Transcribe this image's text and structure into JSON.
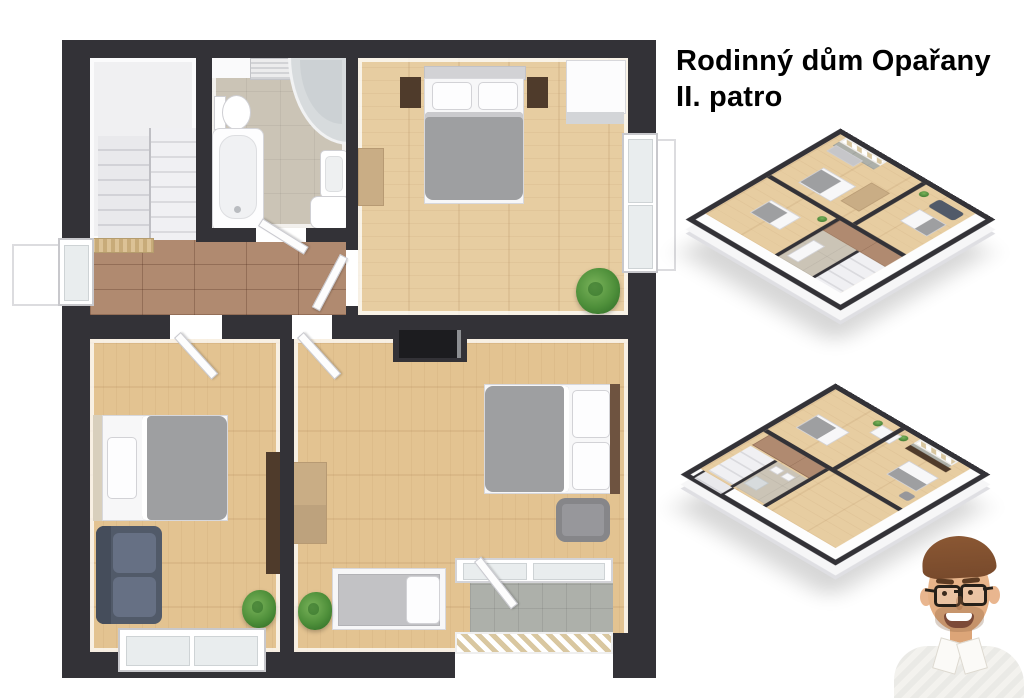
{
  "title": {
    "line1": "Rodinný dům Opařany",
    "line2": "II. patro"
  },
  "legend": [
    "staircase",
    "hallway",
    "bathroom",
    "bathtub",
    "shower",
    "toilet",
    "sink",
    "towel-radiator",
    "double-bed",
    "single-bed",
    "sofa",
    "armchair",
    "wardrobe",
    "nightstand",
    "dresser",
    "desk",
    "plant",
    "window",
    "door",
    "balcony",
    "railing",
    "tv-niche",
    "doormat",
    "agent-photo"
  ],
  "colors": {
    "wall": "#333237",
    "woodFloor": "#e7cda1",
    "woodFloorDeep": "#e3c391",
    "tileFloor": "#b08a70",
    "bathFloor": "#cbc4b6",
    "stairsFloor": "#f0f0f2",
    "balconyFloor": "#adb0aa",
    "railingTan": "#d9c7a0",
    "blanketGray": "#9e9fa1",
    "mattressWhite": "#f7f7f8",
    "sofaNavy": "#515a69",
    "plantGreen": "#4e8f3a",
    "darkWoodBrown": "#4f3b2b",
    "tanWood": "#c9ad85",
    "nicheBlack": "#1c1c1f",
    "skin": "#e9b68f",
    "skinShadow": "#dca578",
    "hairColor": "#784a2c",
    "shirt": "#f3f2ee",
    "glassesFrame": "#262019",
    "titleText": "#000000",
    "background": "#ffffff"
  }
}
